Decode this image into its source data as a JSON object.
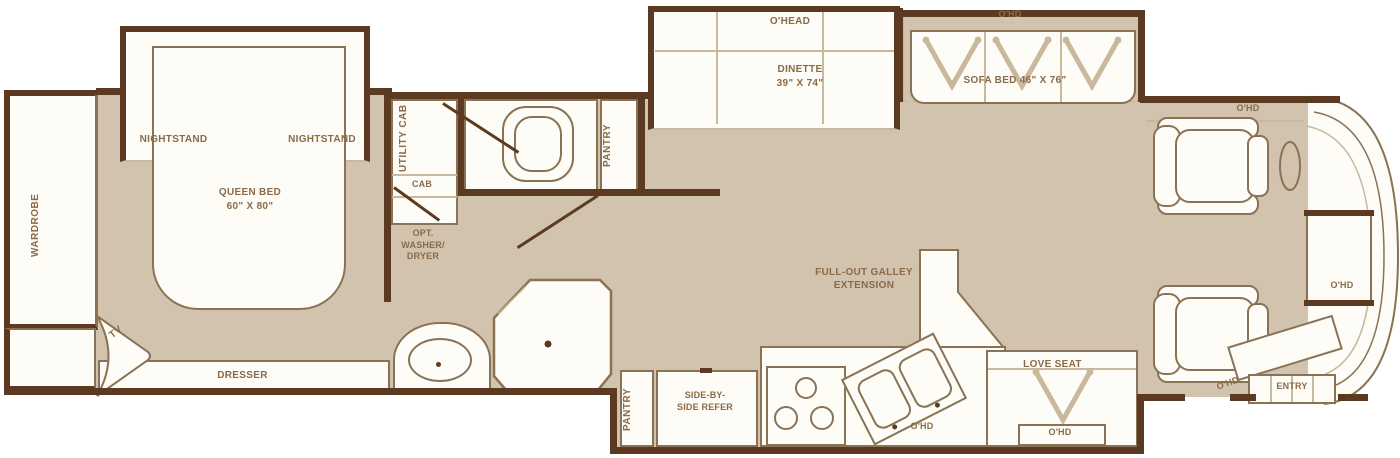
{
  "colors": {
    "wall": "#5b3a21",
    "floor": "#d2c3af",
    "room_fill": "#fdfcf6",
    "outline": "#8a7254",
    "soft_line": "#c8b89c",
    "label_text": "#8a6a48"
  },
  "bedroom": {
    "wardrobe": "WARDROBE",
    "nightstand_left": "NIGHTSTAND",
    "nightstand_right": "NIGHTSTAND",
    "queen_bed": "QUEEN BED",
    "queen_bed_size": "60\" X 80\"",
    "tv": "TV",
    "dresser": "DRESSER"
  },
  "bath": {
    "utility_cab": "UTILITY CAB",
    "cab": "CAB",
    "washer_dryer": "OPT. WASHER/ DRYER",
    "pantry": "PANTRY"
  },
  "dinette": {
    "overhead": "O'HEAD",
    "name": "DINETTE",
    "size": "39\" X 74\""
  },
  "sofa": {
    "overhead": "O'HD",
    "label": "SOFA BED 46\" X 76\""
  },
  "galley": {
    "label": "FULL-OUT GALLEY EXTENSION"
  },
  "kitchen": {
    "pantry": "PANTRY",
    "refrigerator": "SIDE-BY-SIDE REFER",
    "overhead": "O'HD"
  },
  "loveseat": {
    "label": "LOVE SEAT",
    "overhead": "O'HD"
  },
  "cab": {
    "overhead_top": "O'HD",
    "overhead_dash": "O'HD",
    "overhead_entry": "O'HD",
    "entry": "ENTRY"
  }
}
